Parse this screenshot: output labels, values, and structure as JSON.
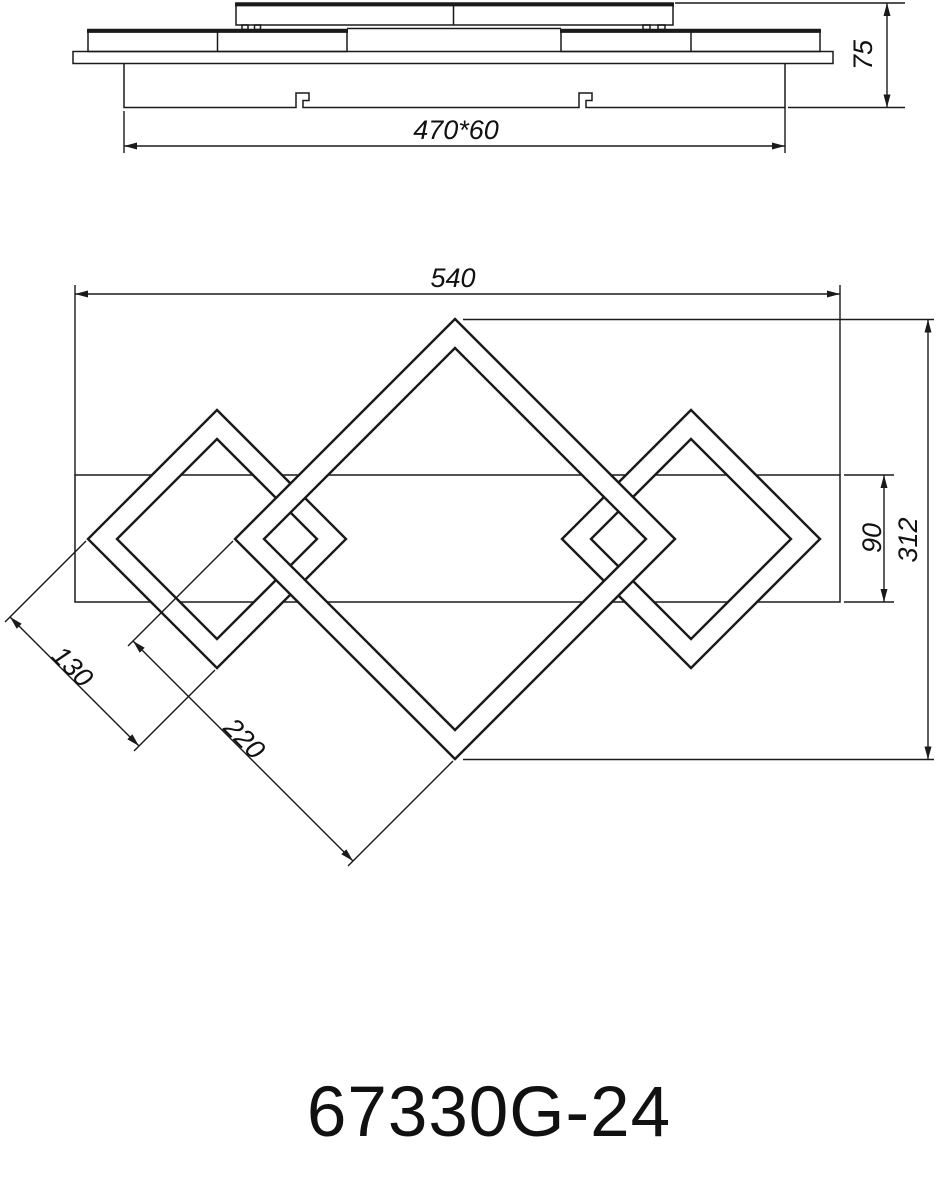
{
  "drawing": {
    "product_code": "67330G-24",
    "side_view": {
      "width_dim": "470*60",
      "height_dim": "75"
    },
    "top_view": {
      "overall_width_dim": "540",
      "overall_height_dim": "312",
      "bar_height_dim": "90",
      "small_frame_dim": "130",
      "large_frame_dim": "220"
    }
  }
}
